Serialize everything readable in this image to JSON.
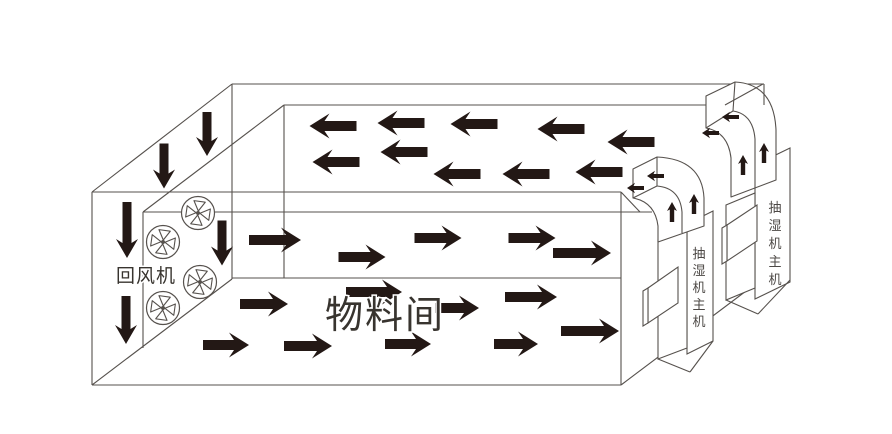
{
  "labels": {
    "return_fan": "回风机",
    "material_room": "物料间"
  },
  "colors": {
    "background": "#ffffff",
    "line": "#56514d",
    "arrow": "#231815",
    "text": "#38342f",
    "unit_label": "#4c4845"
  },
  "room": {
    "lines": [
      [
        92,
        192,
        92,
        385
      ],
      [
        92,
        192,
        232,
        84
      ],
      [
        232,
        84,
        764,
        84
      ],
      [
        284,
        105,
        764,
        105
      ],
      [
        143,
        212,
        284,
        105
      ],
      [
        232,
        84,
        232,
        279
      ],
      [
        92,
        385,
        232,
        279
      ],
      [
        92,
        385,
        621,
        385
      ],
      [
        232,
        278,
        621,
        278
      ],
      [
        621,
        192,
        621,
        385
      ],
      [
        621,
        385,
        762,
        279
      ],
      [
        92,
        192,
        621,
        192
      ],
      [
        143,
        212,
        652,
        212
      ],
      [
        143,
        212,
        143,
        348
      ],
      [
        284,
        105,
        284,
        278
      ]
    ],
    "overlay_lines": [
      [
        725,
        105,
        763,
        84
      ],
      [
        764,
        84,
        764,
        105
      ],
      [
        621,
        192,
        640,
        212
      ]
    ]
  },
  "fans": {
    "radius": 16.5,
    "centers": [
      [
        198,
        213
      ],
      [
        163,
        242
      ],
      [
        200,
        282
      ],
      [
        163,
        308
      ]
    ]
  },
  "airflow": {
    "down": [
      [
        207,
        134,
        44
      ],
      [
        164,
        166,
        45
      ],
      [
        127,
        230,
        56
      ],
      [
        222,
        243,
        45
      ],
      [
        126,
        320,
        48
      ]
    ],
    "left": [
      [
        333,
        126,
        47
      ],
      [
        401,
        123,
        47
      ],
      [
        474,
        124,
        47
      ],
      [
        561,
        129,
        47
      ],
      [
        631,
        142,
        47
      ],
      [
        336,
        162,
        47
      ],
      [
        404,
        152,
        47
      ],
      [
        457,
        174,
        47
      ],
      [
        526,
        174,
        47
      ],
      [
        599,
        172,
        47
      ]
    ],
    "right": [
      [
        275,
        240,
        52
      ],
      [
        362,
        257,
        47
      ],
      [
        438,
        238,
        47
      ],
      [
        532,
        238,
        47
      ],
      [
        582,
        253,
        58
      ],
      [
        264,
        304,
        48
      ],
      [
        226,
        345,
        46
      ],
      [
        374,
        292,
        56
      ],
      [
        457,
        308,
        44
      ],
      [
        531,
        297,
        52
      ],
      [
        590,
        331,
        58
      ],
      [
        408,
        344,
        46
      ],
      [
        308,
        346,
        48
      ],
      [
        516,
        344,
        44
      ]
    ]
  },
  "units": [
    {
      "label": "抽湿机主机",
      "label_x": 699,
      "label_y": 258,
      "label_dy": 17,
      "panel": [
        [
          687,
          224
        ],
        [
          713,
          211
        ],
        [
          713,
          341
        ],
        [
          687,
          354
        ]
      ],
      "body": [
        [
          658,
          240
        ],
        [
          687,
          228
        ],
        [
          687,
          348
        ],
        [
          658,
          359
        ]
      ],
      "side_box": [
        [
          648,
          288
        ],
        [
          678,
          267
        ],
        [
          678,
          303
        ],
        [
          648,
          323
        ]
      ],
      "side_box_front": [
        [
          643,
          291
        ],
        [
          648,
          288
        ],
        [
          648,
          323
        ],
        [
          643,
          326
        ]
      ],
      "base_lines": [
        [
          658,
          359,
          690,
          372
        ],
        [
          690,
          372,
          713,
          341
        ]
      ]
    },
    {
      "label": "抽湿机主机",
      "label_x": 775,
      "label_y": 212,
      "label_dy": 18,
      "panel": [
        [
          755,
          165
        ],
        [
          790,
          148
        ],
        [
          790,
          282
        ],
        [
          755,
          299
        ]
      ],
      "body": [
        [
          726,
          205
        ],
        [
          755,
          193
        ],
        [
          755,
          288
        ],
        [
          726,
          300
        ]
      ],
      "side_box": [
        [
          727,
          225
        ],
        [
          757,
          205
        ],
        [
          757,
          241
        ],
        [
          727,
          261
        ]
      ],
      "side_box_front": [
        [
          722,
          228
        ],
        [
          727,
          225
        ],
        [
          727,
          261
        ],
        [
          722,
          264
        ]
      ],
      "base_lines": [
        [
          726,
          300,
          758,
          314
        ],
        [
          758,
          314,
          790,
          280
        ]
      ]
    }
  ],
  "ducts": [
    {
      "silhouette": "M633,169 L633,198 Q655,202 658,226 L658,242 L704,226 L704,198 Q702,159 657,157 Z",
      "detail_paths": [
        "M657,157 L657,186",
        "M633,198 L657,186",
        "M657,186 Q680,188 682,212 L682,233"
      ],
      "up_arrows": [
        [
          672,
          202
        ],
        [
          694,
          194
        ]
      ],
      "out_arrows": [
        [
          627,
          188
        ],
        [
          647,
          176
        ]
      ]
    },
    {
      "silhouette": "M706,96 L706,128 Q728,132 731,158 L731,197 L776,180 L776,130 Q774,84 735,82 Z",
      "detail_paths": [
        "M735,82 L733,111",
        "M706,128 L733,111",
        "M733,111 Q753,114 755,139 L755,188"
      ],
      "up_arrows": [
        [
          743,
          155
        ],
        [
          764,
          143
        ]
      ],
      "out_arrows": [
        [
          702,
          133
        ],
        [
          722,
          117
        ]
      ]
    }
  ]
}
